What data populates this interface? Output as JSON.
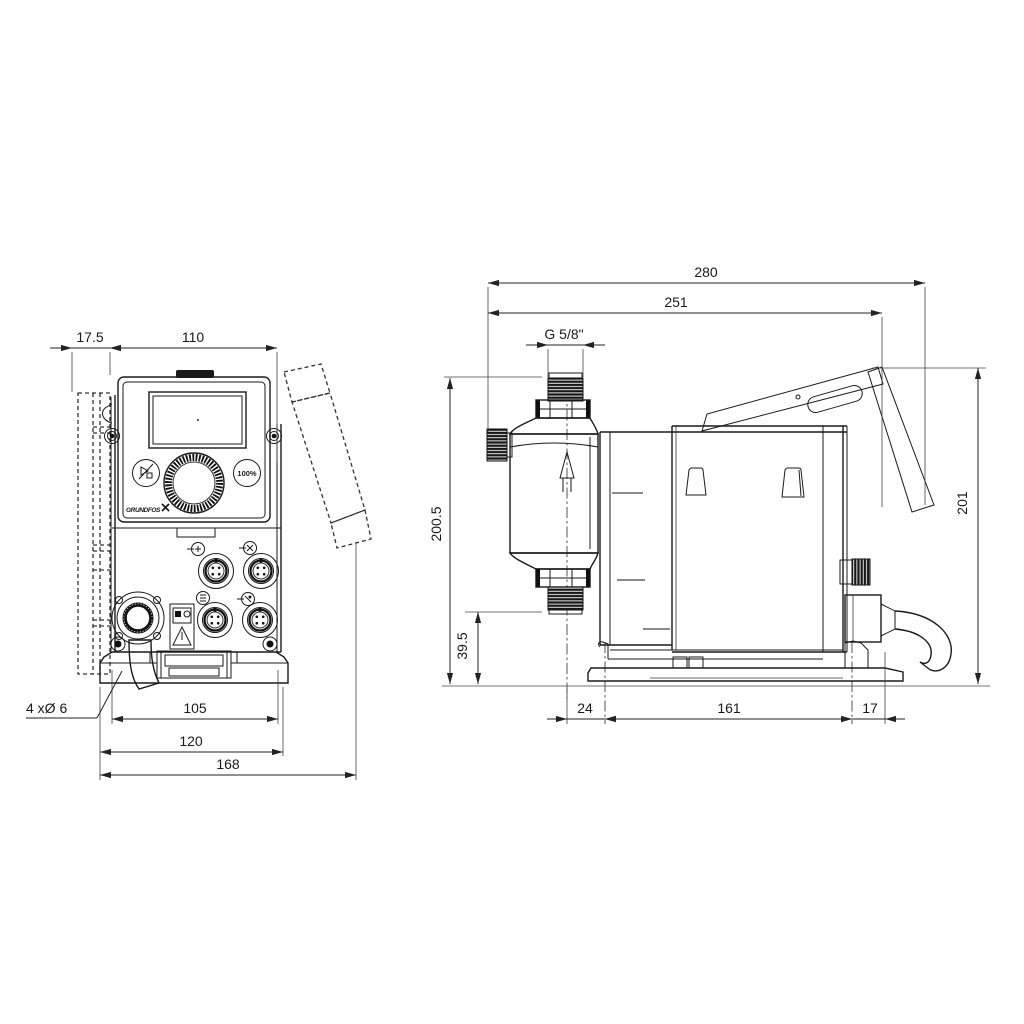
{
  "drawing": {
    "front_view": {
      "dims": {
        "plate_offset": "17.5",
        "body_width": "110",
        "hole_spacing": "105",
        "foot_width": "120",
        "overall_depth": "168",
        "mounting_holes": "4 xØ 6"
      },
      "panel": {
        "full_capacity_button": "100%",
        "brand": "GRUNDFOS"
      }
    },
    "side_view": {
      "dims": {
        "overall_length": "280",
        "length_excl_cable": "251",
        "connection_thread": "G 5/8\"",
        "height_to_connection": "200.5",
        "connection_clearance": "39.5",
        "front_hole_offset": "24",
        "base_hole_spacing": "161",
        "rear_hole_offset": "17",
        "overall_height": "201"
      }
    }
  }
}
